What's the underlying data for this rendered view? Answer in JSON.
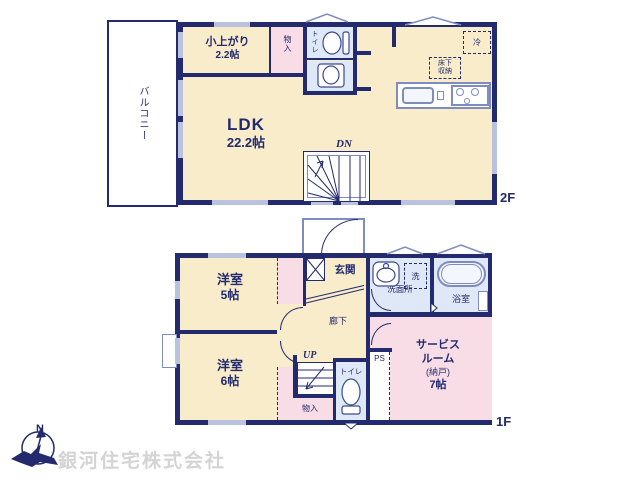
{
  "colors": {
    "wall": "#232a6e",
    "cream": "#f8ecca",
    "pink": "#f8dce6",
    "blue": "#dfe8f7",
    "window": "#b9c3de",
    "fixture": "#7f8cc0",
    "company": "#d4d4d4"
  },
  "floor2": {
    "floor_label": "2F",
    "balcony_label": "バルコニー",
    "koagari_name": "小上がり",
    "koagari_size": "2.2帖",
    "storage_label": "物入",
    "toilet_label": "トイレ",
    "ldk_name": "LDK",
    "ldk_size": "22.2帖",
    "fridge_label": "冷",
    "underfloor_line1": "床下",
    "underfloor_line2": "収納",
    "stairs_label": "DN"
  },
  "floor1": {
    "floor_label": "1F",
    "room5_name": "洋室",
    "room5_size": "5帖",
    "room6_name": "洋室",
    "room6_size": "6帖",
    "entrance_label": "玄関",
    "hallway_label": "廊下",
    "stairs_label": "UP",
    "toilet_label": "トイレ",
    "storage_label": "物入",
    "ps_label": "PS",
    "washroom_label": "洗面所",
    "washer_label": "洗",
    "bath_label": "浴室",
    "service_line1": "サービス",
    "service_line2": "ルーム",
    "service_line3": "(納戸)",
    "service_line4": "7帖"
  },
  "footer": {
    "compass_north": "N",
    "company": "銀河住宅株式会社"
  }
}
